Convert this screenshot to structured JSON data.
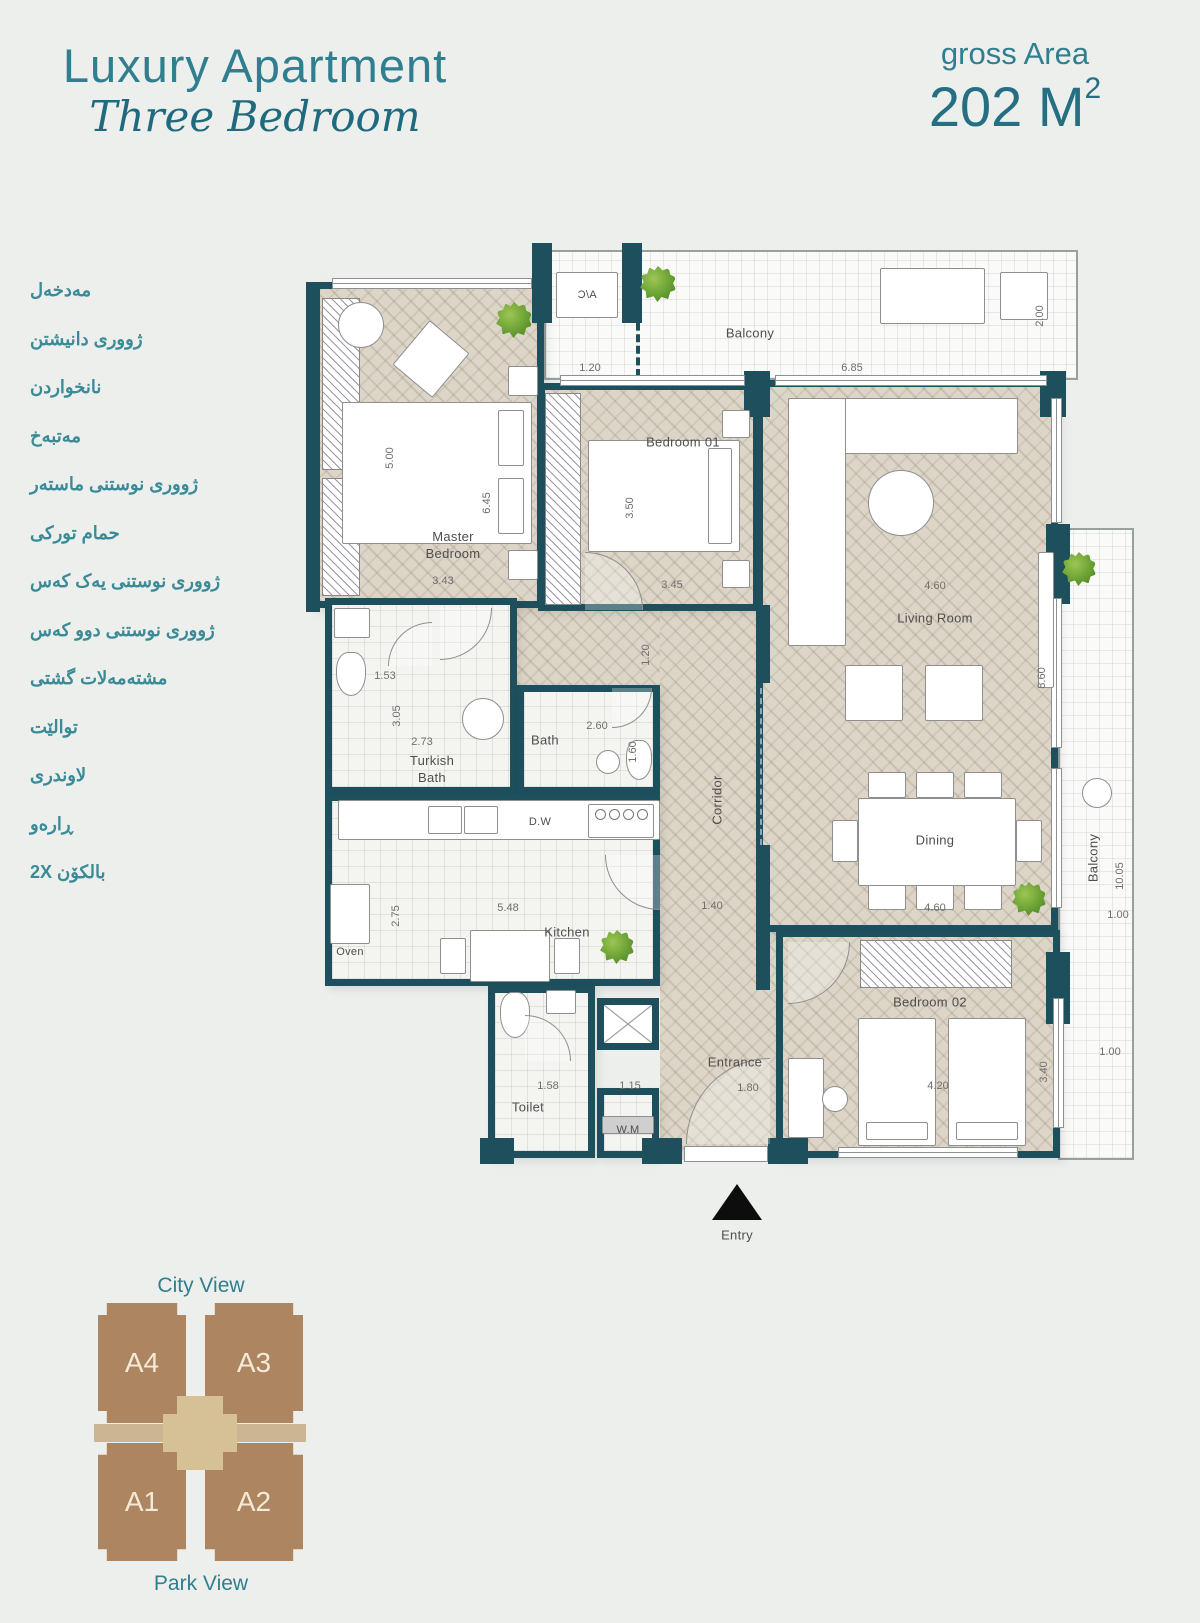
{
  "header": {
    "title": "Luxury Apartment",
    "subtitle": "Three Bedroom",
    "area_label": "gross Area",
    "area_value": "202 M",
    "area_sup": "2"
  },
  "legend": {
    "items": [
      "مەدخەل",
      "ژوورى دانیشتن",
      "نانخواردن",
      "مەتبەخ",
      "ژوورى نوستنى ماستەر",
      "حمام توركى",
      "ژوورى نوستنى یەک کەس",
      "ژوورى نوستنى دوو کەس",
      "مشتەمەلات گشتى",
      "توالێت",
      "لاوندرى",
      "ڕارەو",
      "بالکۆن 2X"
    ]
  },
  "plan": {
    "room_labels": {
      "balcony_top": "Balcony",
      "ac": "A/C",
      "master": "Master Bedroom",
      "bedroom1": "Bedroom 01",
      "living": "Living Room",
      "turkish": "Turkish Bath",
      "bath": "Bath",
      "kitchen": "Kitchen",
      "corridor": "Corridor",
      "dining": "Dining",
      "toilet": "Toilet",
      "wm": "W.M",
      "entrance": "Entrance",
      "bedroom2": "Bedroom 02",
      "balcony_right": "Balcony",
      "entry": "Entry",
      "dw": "D.W",
      "oven": "Oven"
    },
    "dimensions": {
      "balcony_section": "1.20",
      "balcony_length": "6.85",
      "balcony_depth": "2.00",
      "master_len": "5.00",
      "master_bed_len": "6.45",
      "master_width": "3.43",
      "bedroom1_depth": "3.50",
      "bedroom1_width": "3.45",
      "living_width": "4.60",
      "living_length": "8.60",
      "wc_width": "1.53",
      "wc_depth": "3.05",
      "turkish_width": "2.73",
      "bath_width": "2.60",
      "bath_depth": "1.60",
      "corridor_width": "1.20",
      "kitchen_depth": "2.75",
      "kitchen_width": "5.48",
      "corridor_bottom": "1.40",
      "dining_width": "4.60",
      "toilet_width": "1.58",
      "laundry_width": "1.15",
      "entrance_width": "1.80",
      "bedroom2_width": "4.20",
      "bedroom2_depth": "3.40",
      "balcony_right_length": "10.05",
      "balcony_right_width": "1.00",
      "bedroom2_right": "1.00"
    }
  },
  "unit_map": {
    "top_label": "City View",
    "bottom_label": "Park View",
    "units": [
      "A4",
      "A3",
      "A1",
      "A2"
    ]
  },
  "colors": {
    "accent": "#2f7f90",
    "wall": "#1d4f5c",
    "brown": "#ad8560",
    "core": "#d6c096",
    "band": "#cbb592"
  }
}
